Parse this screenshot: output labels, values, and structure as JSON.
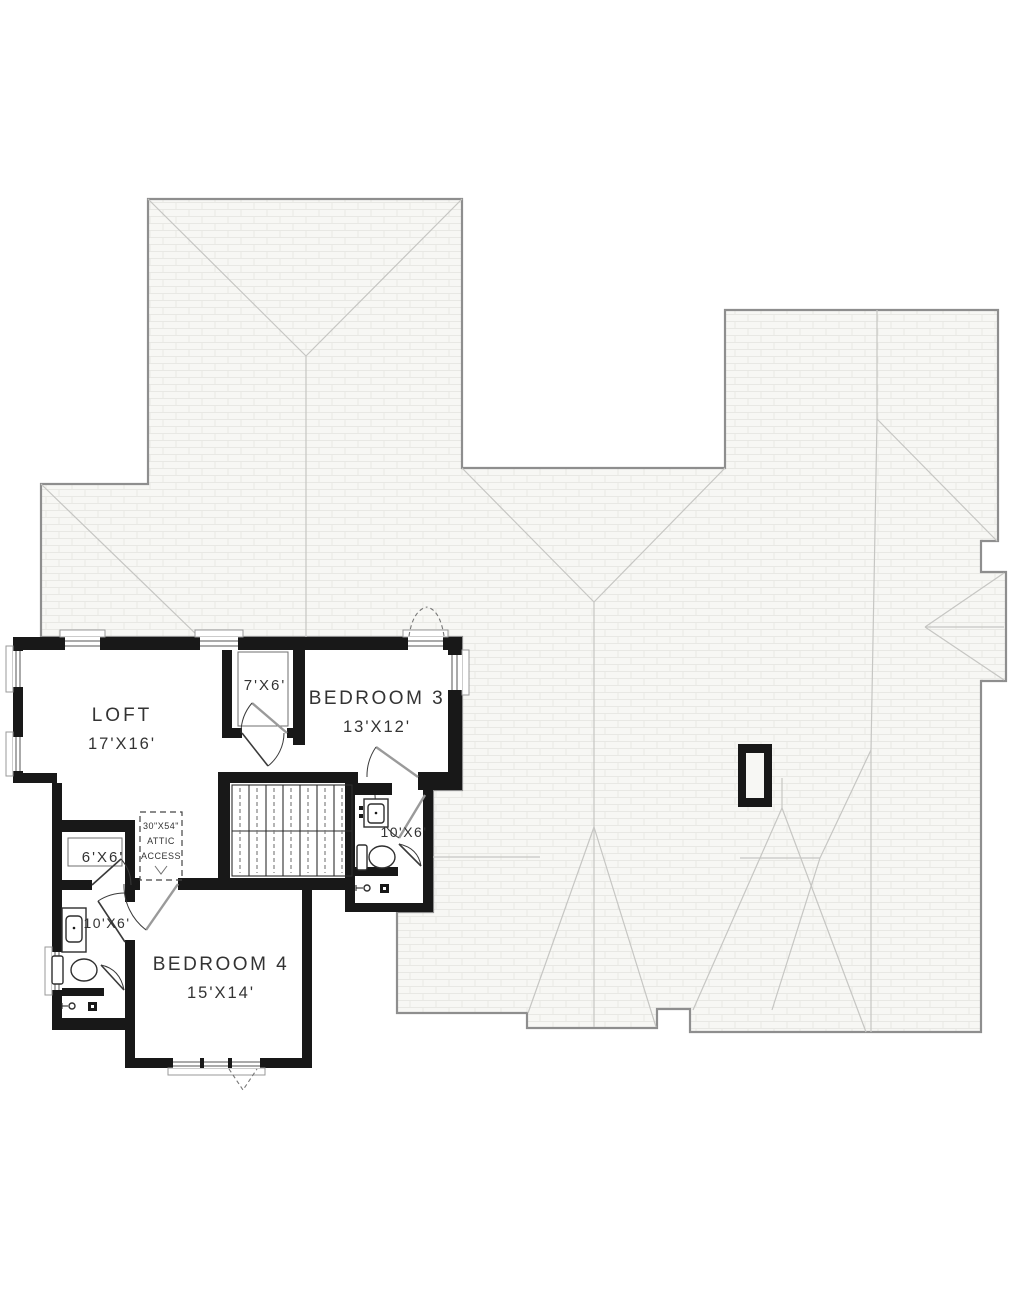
{
  "title": "Second floor plan",
  "colors": {
    "bg": "#ffffff",
    "wall": "#181818",
    "roof-fill": "#f7f7f4",
    "roof-edge": "#8e8e8e",
    "ridge": "#c6c6c3",
    "hatch": "#e8e8e4",
    "text": "#333333",
    "line": "#2e2e2e"
  },
  "rooms": {
    "loft": {
      "name": "LOFT",
      "dims": "17'X16'"
    },
    "bedroom3": {
      "name": "BEDROOM 3",
      "dims": "13'X12'"
    },
    "bedroom4": {
      "name": "BEDROOM 4",
      "dims": "15'X14'"
    },
    "closet_upper": {
      "dims": "7'X6'"
    },
    "closet_lower": {
      "dims": "6'X6'"
    },
    "bath_right": {
      "dims": "10'X6'"
    },
    "bath_left": {
      "dims": "10'X6'"
    },
    "attic_access": {
      "size": "30\"X54\"",
      "line2": "ATTIC",
      "line3": "ACCESS"
    }
  }
}
